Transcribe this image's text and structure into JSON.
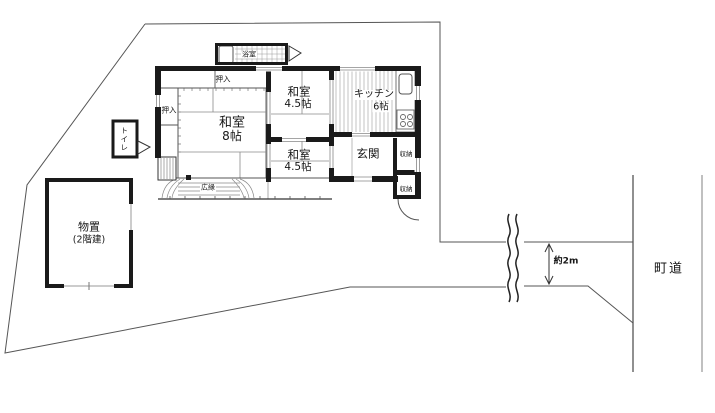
{
  "plan": {
    "rooms": {
      "washitsu_8": {
        "name": "和室",
        "size": "8帖"
      },
      "washitsu_45_north": {
        "name": "和室",
        "size": "4.5帖"
      },
      "washitsu_45_south": {
        "name": "和室",
        "size": "4.5帖"
      },
      "kitchen": {
        "name": "キッチン",
        "size": "6帖"
      },
      "genkan": {
        "name": "玄関"
      },
      "bathroom": {
        "name": "浴室"
      },
      "toilet": {
        "name": "トイレ"
      },
      "hiroen": {
        "name": "広縁"
      },
      "oshiire_north": {
        "name": "押入"
      },
      "oshiire_west": {
        "name": "押入"
      },
      "shuno_upper": {
        "name": "収納"
      },
      "shuno_lower": {
        "name": "収納"
      },
      "shed": {
        "name": "物置",
        "floors": "(2階建)"
      }
    },
    "annotations": {
      "road": "町道",
      "approach_width": "約2m"
    },
    "colors": {
      "wall": "#1a1a1a",
      "boundary": "#555555",
      "thin_line": "#888888",
      "light_line": "#9a9a9a",
      "background": "#ffffff"
    }
  }
}
